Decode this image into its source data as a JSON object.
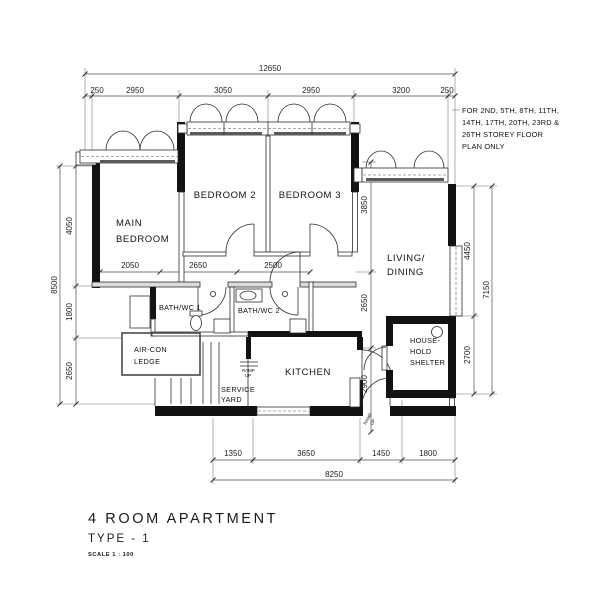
{
  "plan": {
    "note_lines": [
      "FOR 2ND, 5TH, 8TH, 11TH,",
      "14TH, 17TH, 20TH, 23RD &",
      "26TH STOREY FLOOR",
      "PLAN ONLY"
    ],
    "rooms": {
      "main_bedroom": [
        "MAIN",
        "BEDROOM"
      ],
      "bedroom2": "BEDROOM 2",
      "bedroom3": "BEDROOM 3",
      "living": [
        "LIVING/",
        "DINING"
      ],
      "bath1": "BATH/WC 1",
      "bath2": "BATH/WC 2",
      "aircon": [
        "AIR-CON",
        "LEDGE"
      ],
      "kitchen": "KITCHEN",
      "service_yard": [
        "SERVICE",
        "YARD"
      ],
      "shelter": [
        "HOUSE-",
        "HOLD",
        "SHELTER"
      ],
      "ramp_up": [
        "RAMP",
        "UP"
      ]
    },
    "dims": {
      "top_total": "12650",
      "top_segments": [
        "250",
        "2950",
        "3050",
        "2950",
        "3200",
        "250"
      ],
      "left_total": "8500",
      "left_segments": [
        "4050",
        "1800",
        "2650"
      ],
      "right_total": "7150",
      "right_segments": [
        "4450",
        "2700"
      ],
      "mid_horizontal": [
        "2050",
        "2650",
        "2500"
      ],
      "v_3850": "3850",
      "v_2650": "2650",
      "v_2900": "2900",
      "bottom_segments": [
        "1350",
        "3650",
        "1450",
        "1800"
      ],
      "bottom_total": "8250"
    },
    "title": {
      "name": "4 ROOM APARTMENT",
      "type": "TYPE - 1",
      "scale": "SCALE 1 : 100"
    }
  }
}
